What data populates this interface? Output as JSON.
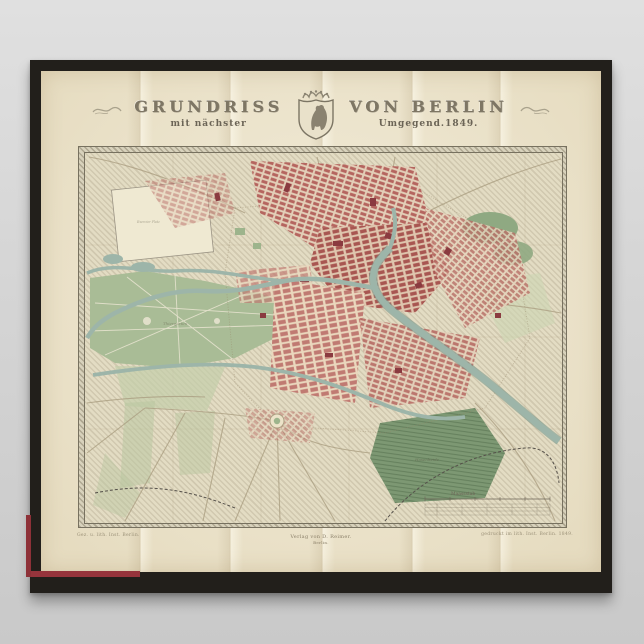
{
  "poster": {
    "title": {
      "grundriss": "GRUNDRISS",
      "von_berlin": "VON BERLIN",
      "mit_naechster": "mit nächster",
      "umgegend": "Umgegend.1849."
    },
    "imprints": {
      "left": "Gez. u. lith. Inst. Berlin.",
      "center_line1": "Verlag von D. Reimer.",
      "center_line2": "Berlin.",
      "right": "gedruckt im lith. Inst. Berlin. 1849."
    },
    "map_labels": {
      "scale": "Maassstab",
      "thiergarten": "Thiergarten",
      "hasenheide": "Hasenheide",
      "exercier_platz": "Exercier Platz"
    },
    "colors": {
      "frame_black": "#221f1b",
      "paper_cream": "#efe7cf",
      "map_ground": "#ece3c9",
      "park_green": "#a9bc96",
      "woods_green": "#7d9873",
      "river_teal": "#9db5a9",
      "city_blocks_red": "#b5655f",
      "book_edge_red": "#96343c",
      "wall_background_gray": "#d6d6d6"
    }
  }
}
